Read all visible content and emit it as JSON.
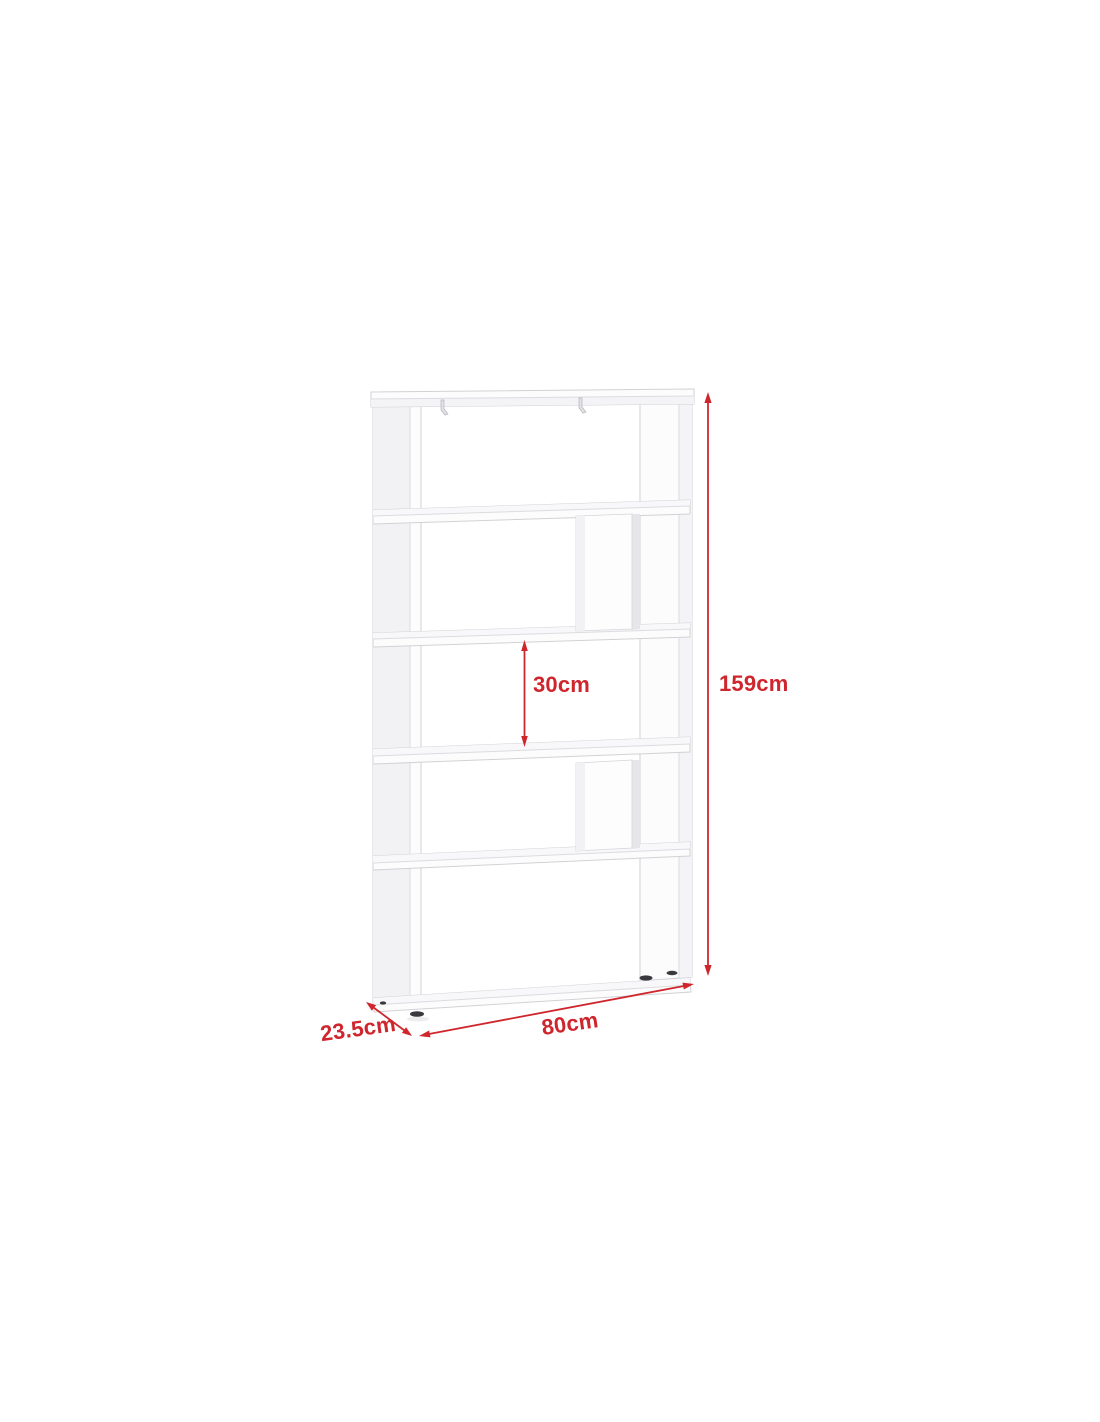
{
  "diagram": {
    "description": "white 5-tier zigzag bookcase shown in light perspective with red dimension arrows",
    "background_color": "#ffffff",
    "annotation_color": "#cf262e",
    "outline_color": "#d2d2d6",
    "panel_color": "#fcfcfd",
    "labels": {
      "total_height": "159cm",
      "shelf_spacing": "30cm",
      "width": "80cm",
      "depth": "23.5cm"
    }
  }
}
